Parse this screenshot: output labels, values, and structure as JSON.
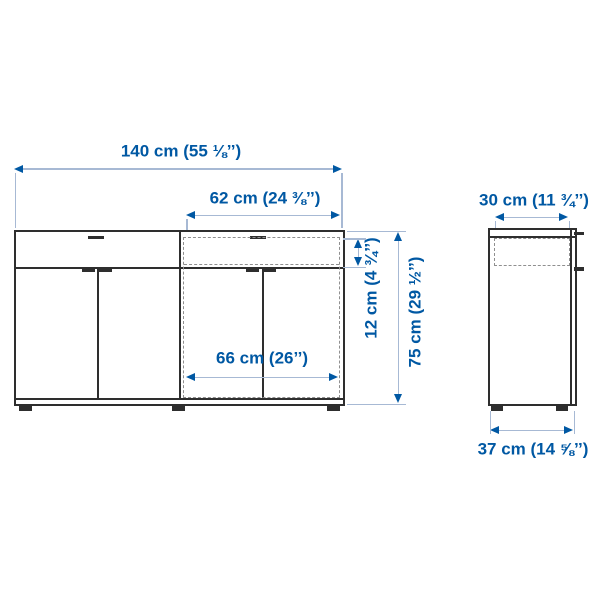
{
  "colors": {
    "accent": "#0058a3",
    "dim_line": "#a7b9d4",
    "furniture_line": "#2e2e2e",
    "highlight_dash": "#8f8f8f",
    "background": "#ffffff"
  },
  "front_view": {
    "dimensions": {
      "overall_width": "140 cm (55 ⅛’’)",
      "highlight_unit_width": "62 cm (24 ⅜’’)",
      "drawer_height": "12 cm (4 ¾’’)",
      "overall_height": "75 cm (29 ½’’)",
      "door_section_width": "66 cm (26’’)"
    }
  },
  "side_view": {
    "dimensions": {
      "top_depth": "30 cm (11 ¾’’)",
      "base_depth": "37 cm (14 ⅝’’)"
    }
  }
}
